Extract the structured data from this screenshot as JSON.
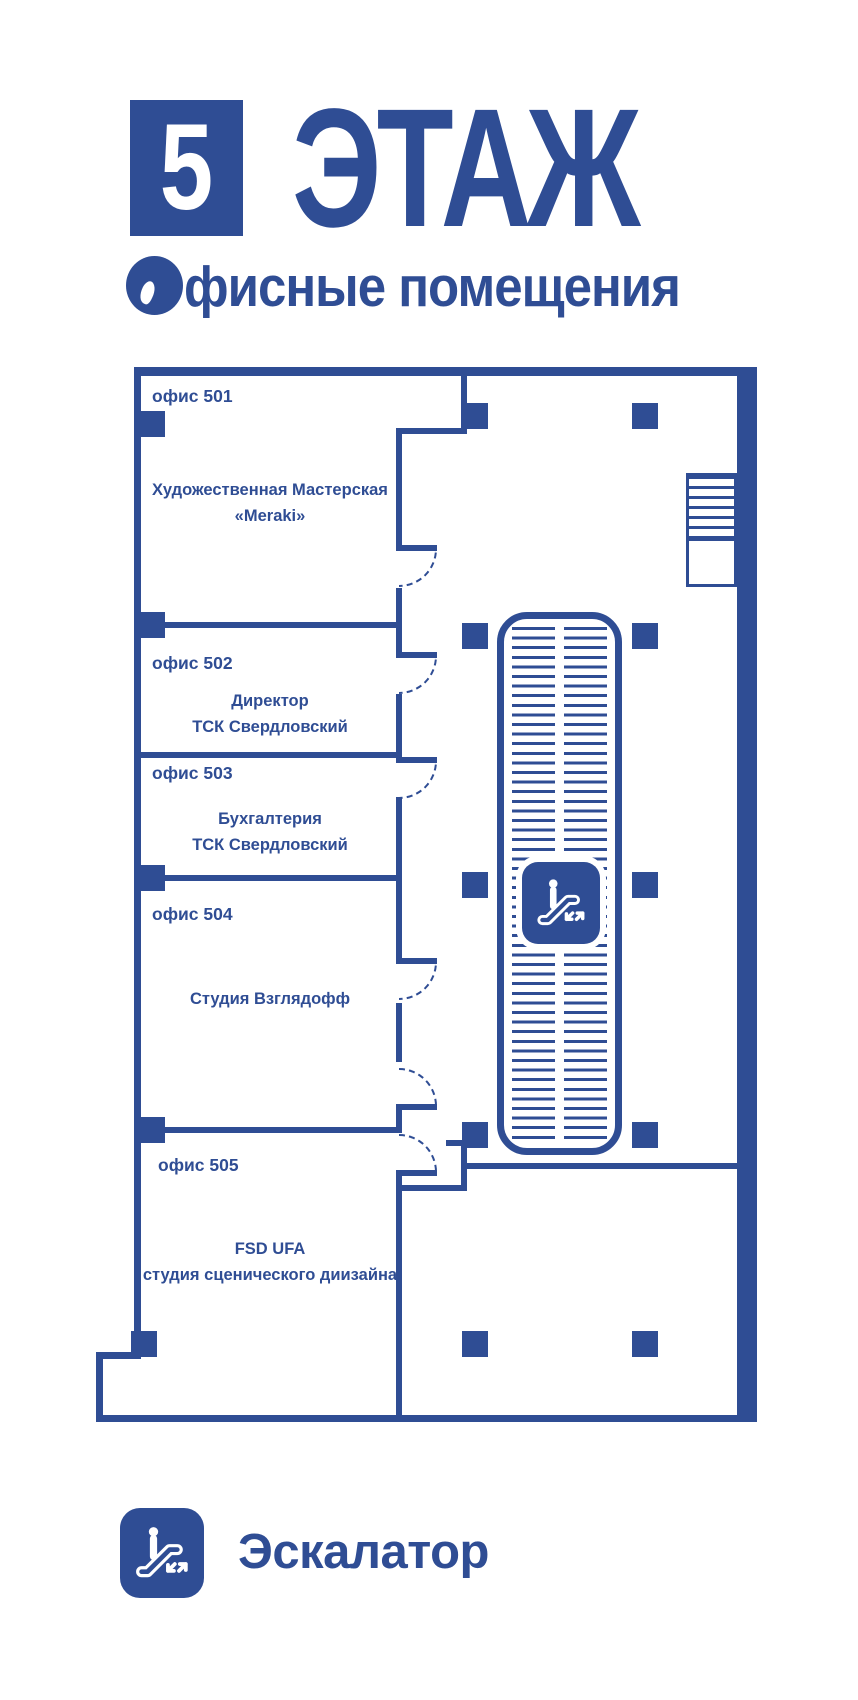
{
  "colors": {
    "primary": "#2F4D94",
    "background": "#FFFFFF"
  },
  "header": {
    "floor_number": "5",
    "floor_word": "ЭТАЖ",
    "subtitle": "Офисные помещения",
    "subtitle_rest": "фисные помещения"
  },
  "plan": {
    "rooms": [
      {
        "label": "офис 501",
        "line1": "Художественная Мастерская",
        "line2": "«Meraki»"
      },
      {
        "label": "офис 502",
        "line1": "Директор",
        "line2": "ТСК Свердловский"
      },
      {
        "label": "офис 503",
        "line1": "Бухгалтерия",
        "line2": "ТСК Свердловский"
      },
      {
        "label": "офис 504",
        "line1": "Студия Взглядофф",
        "line2": ""
      },
      {
        "label": "офис 505",
        "line1": "FSD UFA",
        "line2": "студия сценического диизайна"
      }
    ],
    "features": {
      "escalator": "escalator-well",
      "stairs": "stairs",
      "doors": 6,
      "pillars": "structural columns"
    }
  },
  "legend": {
    "label": "Эскалатор",
    "icon": "escalator-icon"
  }
}
